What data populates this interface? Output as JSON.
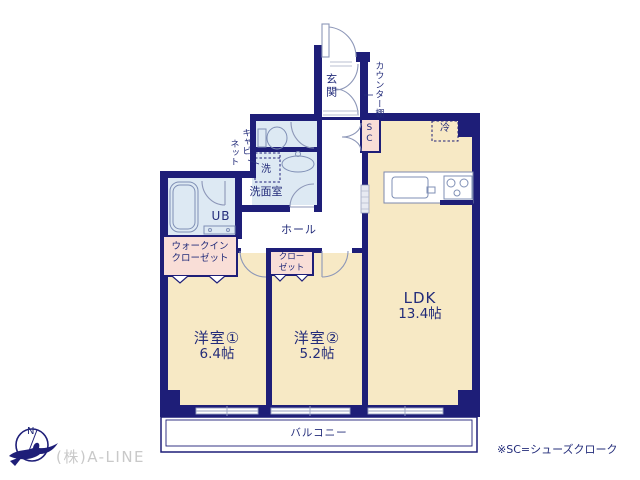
{
  "rooms": {
    "ldk": {
      "name": "LDK",
      "size": "13.4帖"
    },
    "bedroom1": {
      "name": "洋室①",
      "size": "6.4帖"
    },
    "bedroom2": {
      "name": "洋室②",
      "size": "5.2帖"
    },
    "entrance": {
      "label": "玄関"
    },
    "hall": {
      "label": "ホール"
    },
    "washroom": {
      "label": "洗面室"
    },
    "unit_bath": {
      "label": "UB"
    },
    "walk_in_closet": {
      "line1": "ウォークイン",
      "line2": "クローゼット"
    },
    "closet": {
      "line1": "クロー",
      "line2": "ゼット"
    },
    "shoes_cloak": {
      "label": "SC"
    },
    "balcony": {
      "label": "バルコニー"
    }
  },
  "fixtures": {
    "refrigerator": "冷",
    "washing_machine": "洗",
    "counter_shelf": "カウンター棚",
    "cabinet": {
      "line1": "キャビ",
      "line2": "ネット"
    }
  },
  "compass": {
    "north_label": "N"
  },
  "footer": {
    "note": "※SC=シューズクローク",
    "company": "(株)A-LINE"
  },
  "colors": {
    "wall_navy": "#1e1e78",
    "room_beige": "#f7e9c5",
    "water_blue": "#dde9f3",
    "closet_pink": "#f9ded7",
    "text_navy": "#232c7a",
    "fixture_stroke": "#7f8fb5",
    "logo_gray": "#c9c9c9"
  }
}
